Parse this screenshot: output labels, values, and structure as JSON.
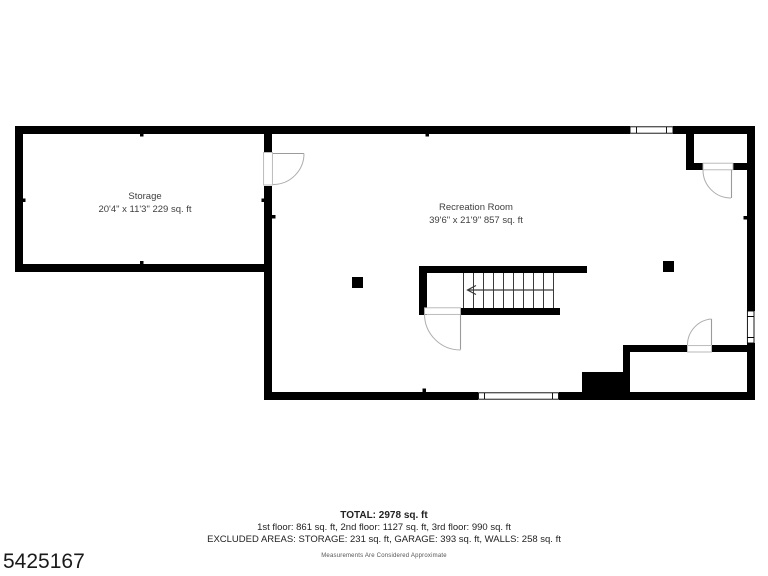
{
  "floorplan": {
    "level": "basement",
    "wall_color": "#000000",
    "door_color": "#9b9b9b",
    "rooms": [
      {
        "name": "Storage",
        "dims": "20'4\" x 11'3\" 229 sq. ft"
      },
      {
        "name": "Recreation Room",
        "dims": "39'6\" x 21'9\" 857 sq. ft"
      }
    ]
  },
  "summary": {
    "total": "TOTAL: 2978 sq. ft",
    "floors": "1st floor: 861 sq. ft, 2nd floor: 1127 sq. ft, 3rd floor: 990 sq. ft",
    "excluded": "EXCLUDED AREAS: STORAGE: 231 sq. ft, GARAGE: 393 sq. ft, WALLS: 258 sq. ft",
    "disclaimer": "Measurements Are Considered Approximate"
  },
  "mls_number": "5425167"
}
